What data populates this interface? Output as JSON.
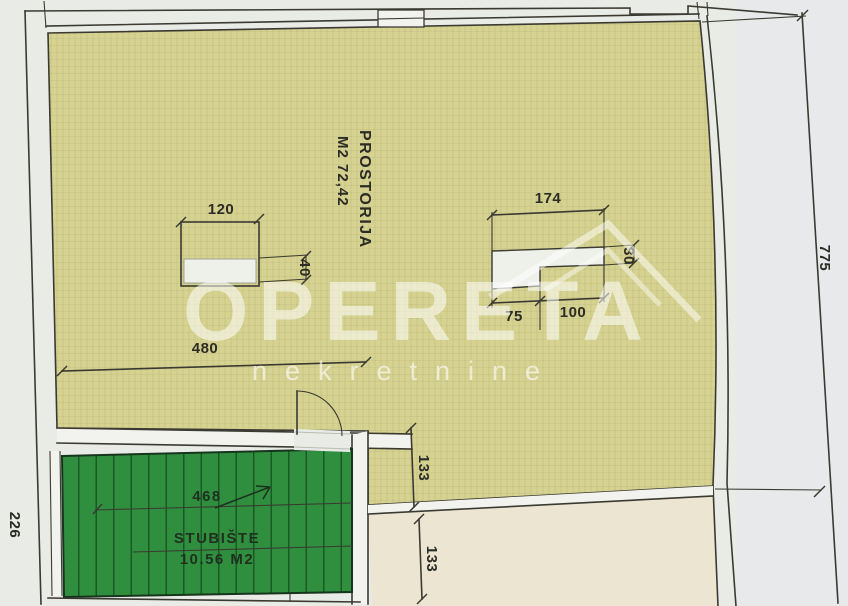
{
  "room": {
    "name": "PROSTORIJA",
    "area": "M2 72,42"
  },
  "stairs": {
    "name": "STUBIŠTE",
    "area": "10.56 M2",
    "run_dim": "468"
  },
  "dims": {
    "win_left_w": "120",
    "win_left_d": "40",
    "win_right_w": "174",
    "win_right_d": "30",
    "win_right_a": "75",
    "win_right_b": "100",
    "room_w": "480",
    "off_top": "133",
    "off_bottom": "133",
    "side_right": "775",
    "side_left": "226"
  },
  "watermark": {
    "brand": "OPERETA",
    "sub": "nekretnine"
  },
  "colors": {
    "paper": "#e9ebe7",
    "line": "#3b3a32",
    "room_fill": "#d6d291",
    "stairs_fill": "#2f8f3f",
    "lower_fill": "#ece5d2"
  }
}
